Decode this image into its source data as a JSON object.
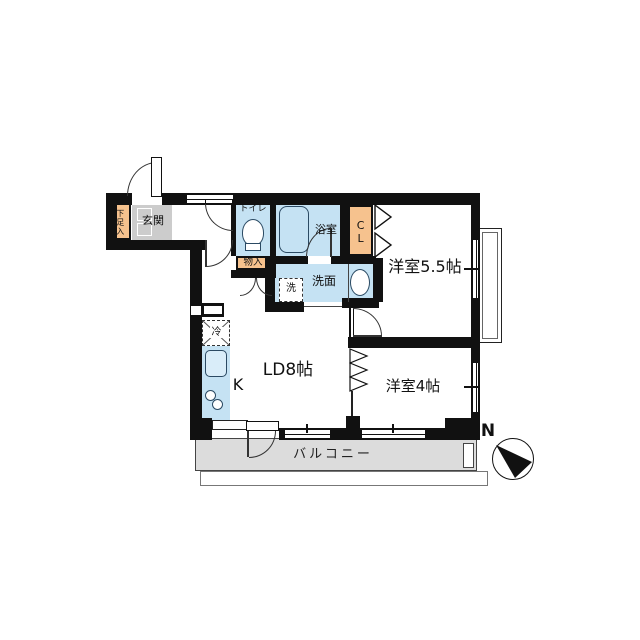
{
  "floorplan": {
    "labels": {
      "entrance": "玄関",
      "shoe_cabinet": "下足入",
      "toilet": "トイレ",
      "storage": "物入",
      "bathroom": "浴室",
      "closet": "CL",
      "western_room_large": "洋室5.5帖",
      "washer": "洗",
      "washroom": "洗面",
      "living_dining": "LD8帖",
      "kitchen": "K",
      "refrigerator": "冷",
      "western_room_small": "洋室4帖",
      "balcony": "バルコニー",
      "compass_north": "N"
    },
    "colors": {
      "wall": "#111111",
      "room_blue": "#c5e2f3",
      "room_orange": "#f6c28e",
      "entrance_gray": "#cccccc",
      "balcony_gray": "#dcdcdc"
    }
  }
}
